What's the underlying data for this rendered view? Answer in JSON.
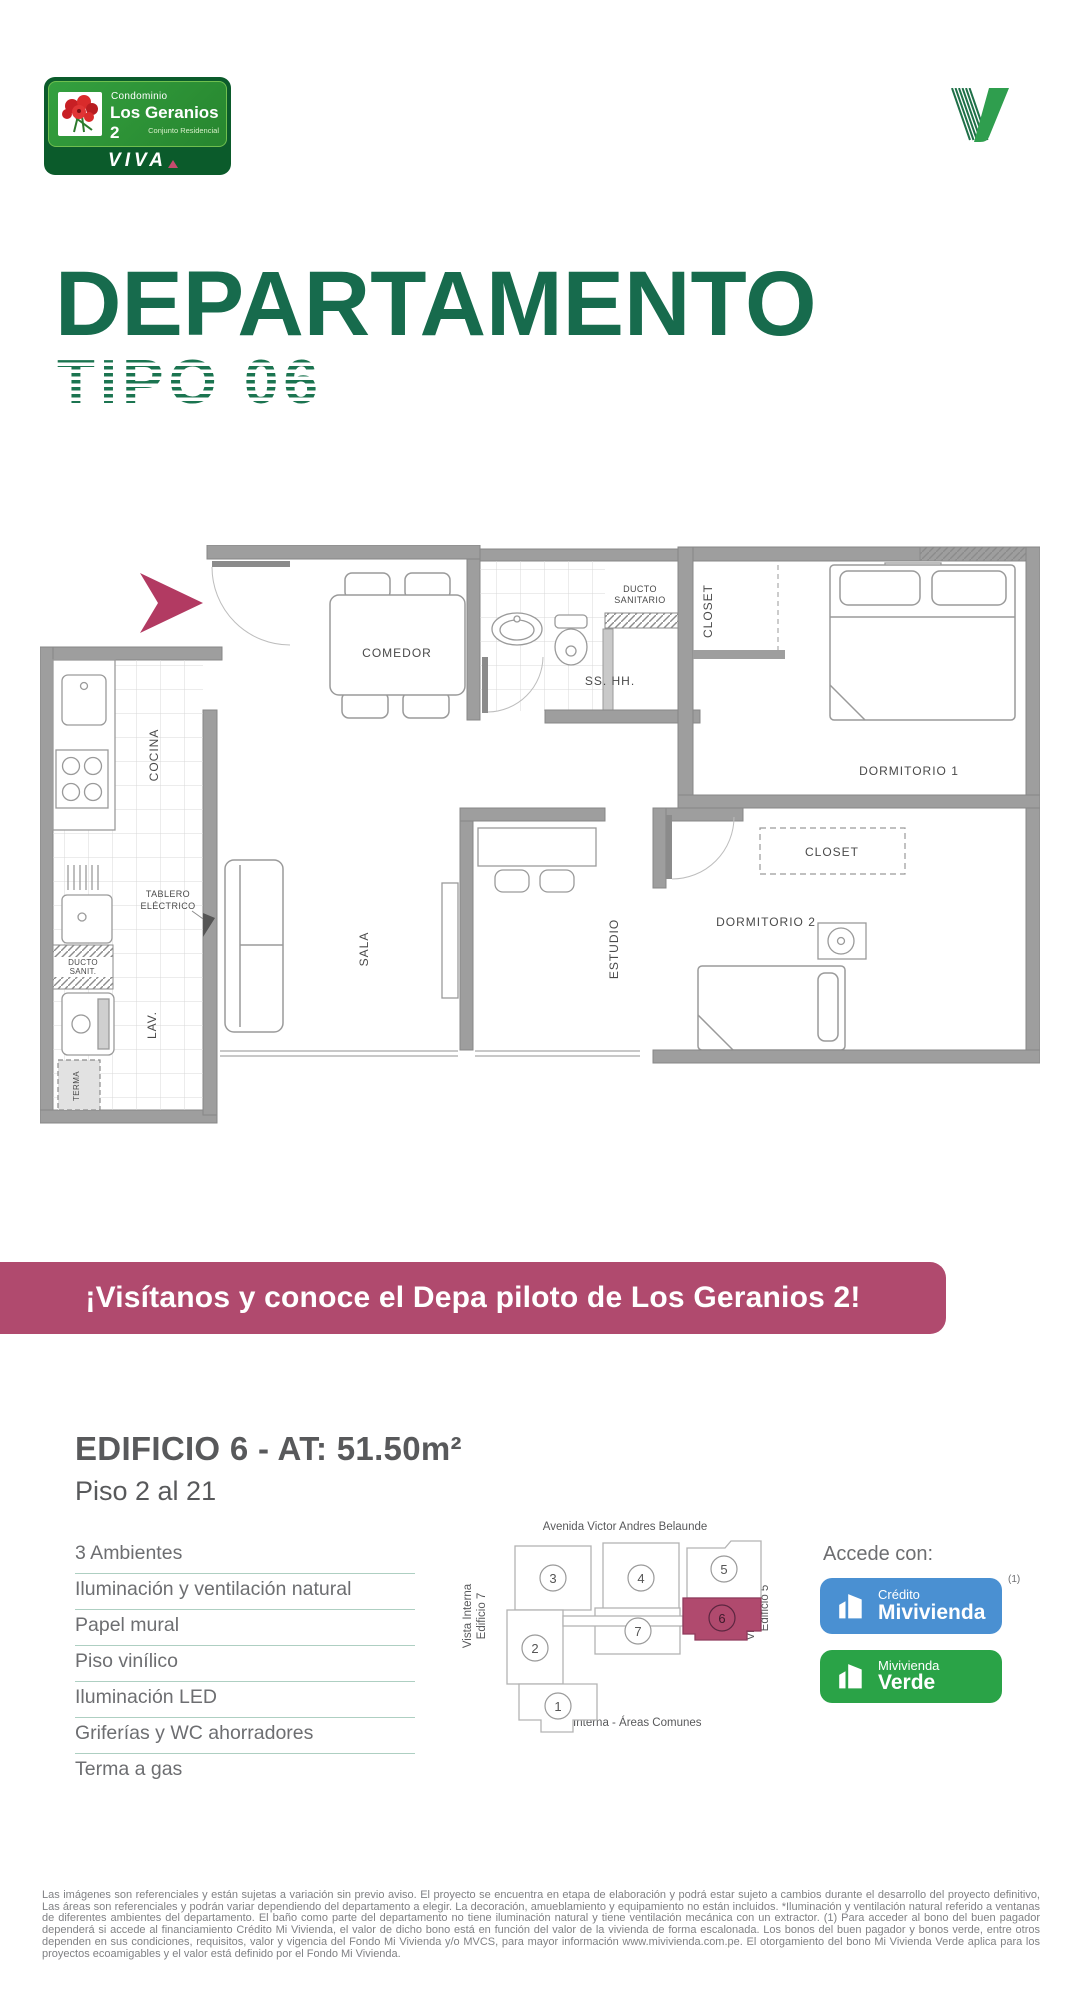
{
  "header": {
    "logo": {
      "line1": "Condominio",
      "name": "Los Geranios 2",
      "subtitle": "Conjunto Residencial",
      "brand": "VIVA"
    }
  },
  "title": {
    "main": "DEPARTAMENTO",
    "sub": "TIPO 06"
  },
  "plan": {
    "labels": {
      "comedor": "COMEDOR",
      "ducto_sanitario_1": "DUCTO",
      "ducto_sanitario_2": "SANITARIO",
      "ss_hh": "SS. HH.",
      "closet_1": "CLOSET",
      "dormitorio_1": "DORMITORIO 1",
      "cocina": "COCINA",
      "tablero_1": "TABLERO",
      "tablero_2": "ELÉCTRICO",
      "sala": "SALA",
      "estudio": "ESTUDIO",
      "closet_2": "CLOSET",
      "dormitorio_2": "DORMITORIO 2",
      "ducto_sanit_1": "DUCTO",
      "ducto_sanit_2": "SANIT.",
      "lav": "LAV.",
      "terma": "TERMA"
    }
  },
  "banner": {
    "text": "¡Visítanos y conoce el Depa piloto de Los Geranios 2!",
    "bg": "#b04a6e"
  },
  "details": {
    "building": "EDIFICIO 6 - AT: 51.50m²",
    "floors": "Piso 2 al 21",
    "features": [
      "3 Ambientes",
      "Iluminación y ventilación natural",
      "Papel mural",
      "Piso vinílico",
      "Iluminación LED",
      "Griferías y WC ahorradores",
      "Terma a gas"
    ]
  },
  "sitemap": {
    "avenue": "Avenida Victor Andres Belaunde",
    "left_label_1": "Vista Interna",
    "left_label_2": "Edificio 7",
    "right_label_1": "Vista Interna",
    "right_label_2": "Edificio 5",
    "bottom_label": "Vista Interna - Áreas Comunes",
    "units": [
      "1",
      "2",
      "3",
      "4",
      "5",
      "6",
      "7"
    ],
    "highlighted_unit": "6",
    "highlight_color": "#b04a6e"
  },
  "access": {
    "title": "Accede con:",
    "footnote": "(1)",
    "credito_line1": "Crédito",
    "credito_line2": "Mivivienda",
    "credito_bg": "#4a90d2",
    "verde_line1": "Mivivienda",
    "verde_line2": "Verde",
    "verde_bg": "#2aa347"
  },
  "disclaimer": {
    "text": "Las imágenes son referenciales y están sujetas a variación sin previo aviso. El proyecto se encuentra en etapa de elaboración y podrá estar sujeto a cambios durante el desarrollo del proyecto definitivo, Las áreas son referenciales y podrán variar dependiendo del departamento a elegir. La decoración, amueblamiento y equipamiento no están incluidos. *Iluminación y ventilación natural referido a ventanas de diferentes ambientes del departamento. El baño como parte del departamento no tiene iluminación natural y tiene ventilación mecánica con un extractor. (1) Para acceder al bono del buen pagador dependerá si accede al financiamiento Crédito Mi Vivienda, el valor de dicho bono está en función del valor de la vivienda de forma escalonada. Los bonos del buen pagador y bonos verde, entre otros dependen en sus condiciones, requisitos, valor y vigencia del Fondo Mi Vivienda y/o MVCS, para mayor información www.mivivienda.com.pe. El otorgamiento del bono Mi Vivienda Verde aplica para los proyectos ecoamigables y el valor está definido por el Fondo Mi Vivienda."
  }
}
